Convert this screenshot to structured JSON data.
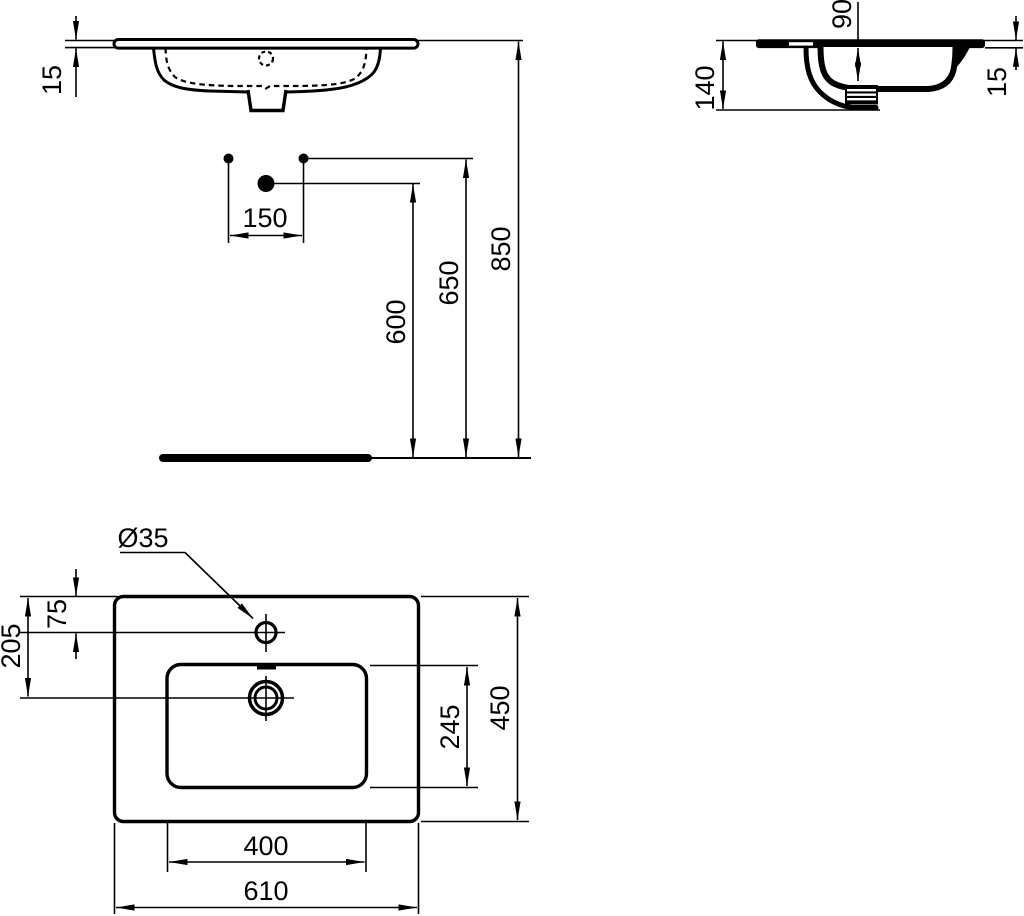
{
  "drawing": {
    "units": "mm",
    "ink_color": "#000000",
    "paper_color": "#ffffff",
    "front_view": {
      "rim_thickness": "15",
      "tap_hole_spacing": "150",
      "waste_height": "600",
      "fixing_holes_height": "650",
      "rim_height": "850"
    },
    "side_view": {
      "bowl_depth": "90",
      "body_height": "140",
      "rim_thickness": "15"
    },
    "plan_view": {
      "tap_hole_diameter": "Ø35",
      "tap_hole_offset": "75",
      "waste_offset": "205",
      "bowl_front_to_back": "245",
      "overall_depth": "450",
      "bowl_width": "400",
      "overall_width": "610"
    }
  }
}
